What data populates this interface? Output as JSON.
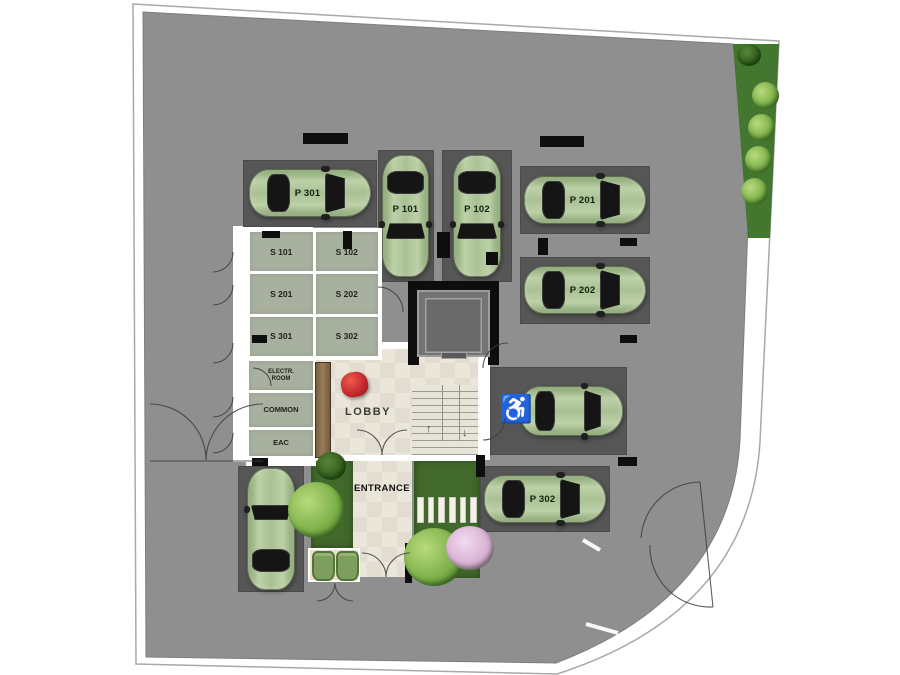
{
  "plan": {
    "title": "ground-floor parking site plan",
    "palette": {
      "asphalt": "#8f8f8f",
      "parking_bay": "#565656",
      "car_green": "#a9c094",
      "room_floor": "#a8b09f",
      "lobby_tile": "#e8e3d6",
      "garden_green": "#41692c",
      "wood_desk": "#8a6f52",
      "accent_red": "#c1272d",
      "wall_white": "#ffffff",
      "wall_black": "#0e0e0e"
    },
    "parking_spaces": [
      {
        "id": "p301",
        "label": "P 301"
      },
      {
        "id": "p101",
        "label": "P 101"
      },
      {
        "id": "p102",
        "label": "P 102"
      },
      {
        "id": "p201",
        "label": "P 201"
      },
      {
        "id": "p202",
        "label": "P 202"
      },
      {
        "id": "accessible",
        "label": ""
      },
      {
        "id": "p302",
        "label": "P 302"
      },
      {
        "id": "visitor",
        "label": ""
      }
    ],
    "storage_rooms": {
      "cells": [
        "S 101",
        "S 102",
        "S 201",
        "S 202",
        "S 301",
        "S 302"
      ]
    },
    "service_rooms": {
      "electrical": [
        "ELECTR.",
        "ROOM"
      ],
      "common": "COMMON",
      "eac": "EAC"
    },
    "lobby_label": "LOBBY",
    "entrance_label": "ENTRANCE",
    "icons": {
      "wheelchair": "♿",
      "stairs_up": "↑",
      "stairs_down": "↓"
    }
  }
}
